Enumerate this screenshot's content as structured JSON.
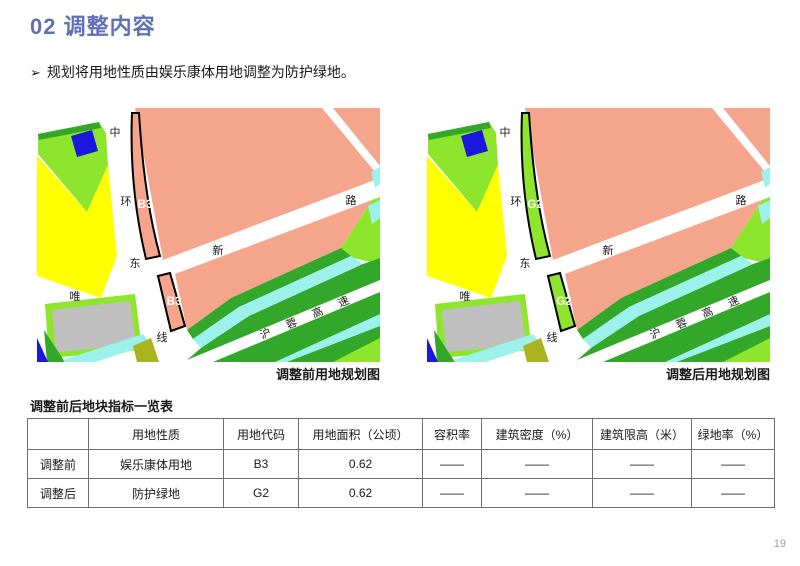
{
  "page": {
    "title": "02 调整内容",
    "accent_color": "#5F70B5",
    "bullet_marker": "➢",
    "bullet": "规划将用地性质由娱乐康体用地调整为防护绿地。",
    "page_number": "19"
  },
  "maps": {
    "before": {
      "caption": "调整前用地规划图",
      "parcel_code": "B3",
      "parcel_fill": "#F4A58C"
    },
    "after": {
      "caption": "调整后用地规划图",
      "parcel_code": "G2",
      "parcel_fill": "#8DE52D"
    },
    "road_labels": {
      "ring": [
        "中",
        "环",
        "东",
        "线"
      ],
      "wei": "唯",
      "xin": [
        "新",
        "路"
      ],
      "highway": [
        "沪",
        "蓉",
        "高",
        "速"
      ]
    },
    "colors": {
      "pink": "#F4A58C",
      "yellow": "#FFFF00",
      "light_green": "#8DE52D",
      "dark_green": "#33A72A",
      "cyan": "#9CF2EA",
      "blue": "#1A18DC",
      "gray": "#BFBFBF",
      "olive": "#AAB420",
      "parcel_outline": "#000000",
      "parcel_label": "#FFFFFF",
      "road_text": "#1a1a1a"
    }
  },
  "table": {
    "title": "调整前后地块指标一览表",
    "headers": [
      "",
      "用地性质",
      "用地代码",
      "用地面积（公顷）",
      "容积率",
      "建筑密度（%）",
      "建筑限高（米）",
      "绿地率（%）"
    ],
    "rows": [
      [
        "调整前",
        "娱乐康体用地",
        "B3",
        "0.62",
        "——",
        "——",
        "——",
        "——"
      ],
      [
        "调整后",
        "防护绿地",
        "G2",
        "0.62",
        "——",
        "——",
        "——",
        "——"
      ]
    ]
  }
}
